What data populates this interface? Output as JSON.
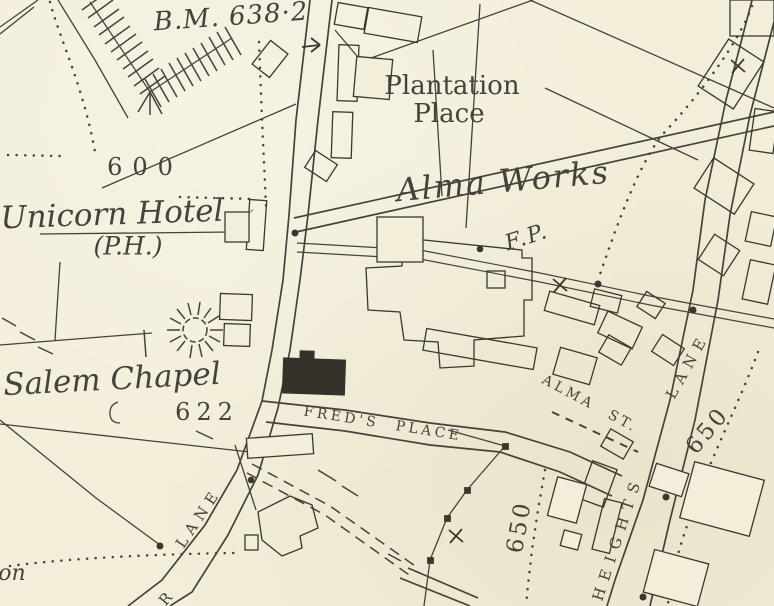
{
  "map": {
    "title": "Victorian Ordnance Survey town plan extract",
    "colors": {
      "paper": "#f3eed9",
      "ink": "#46413a",
      "building_solid": "#35312a"
    },
    "labels": {
      "benchmark": "B.M. 638·2",
      "plantation_line1": "Plantation",
      "plantation_line2": "Place",
      "alma_works": "Alma Works",
      "footpath_abbr": "F.P.",
      "unicorn_hotel": "Unicorn Hotel",
      "unicorn_hotel_ph": "(P.H.)",
      "salem_chapel": "Salem Chapel",
      "partial_word_on": "on"
    },
    "numbers": {
      "level_600": "600",
      "level_622": "622",
      "level_650_a": "650",
      "level_650_b": "650"
    },
    "streets": {
      "freds_place": "FRED'S PLACE",
      "alma_st": "ALMA ST.",
      "heights": "HEIGHTS",
      "heights_lane_word": "LANE",
      "lane_left": "LANE",
      "lane_left_partial": "R"
    },
    "symbols": {
      "boundary_cross": "X boundary mark",
      "shaft": "old shaft / well sunburst",
      "flow_arrow": "direction arrow"
    }
  }
}
